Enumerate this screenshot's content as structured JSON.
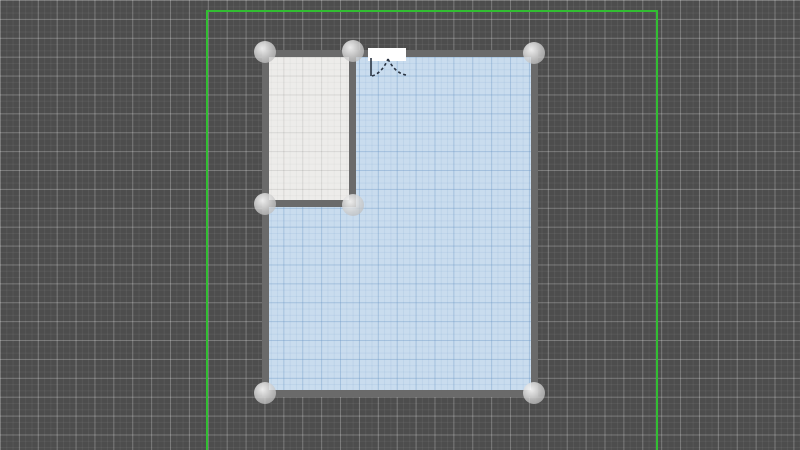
{
  "app": {
    "name": "floor-plan-editor",
    "view": "2d-plan-canvas"
  },
  "canvas": {
    "width": 800,
    "height": 450,
    "background_color": "#4d4d4d",
    "grid": {
      "minor_size_px": 6.3,
      "major_size_px": 18.9,
      "minor_color": "rgba(255,255,255,0.055)",
      "major_color": "rgba(255,255,255,0.21)"
    },
    "plot_boundary": {
      "color": "#32be32",
      "thickness_px": 2,
      "left_x": 206,
      "top_y": 10,
      "right_x": 656,
      "bottom_y": 450
    }
  },
  "walls": {
    "color": "#6a6a6a",
    "thickness_px": 7,
    "segments": [
      {
        "id": "top-wall",
        "x": 262,
        "y": 50,
        "w": 276,
        "h": 7
      },
      {
        "id": "bottom-wall",
        "x": 262,
        "y": 390,
        "w": 276,
        "h": 7
      },
      {
        "id": "left-wall",
        "x": 262,
        "y": 50,
        "w": 7,
        "h": 347
      },
      {
        "id": "right-wall",
        "x": 531,
        "y": 50,
        "w": 7,
        "h": 347
      },
      {
        "id": "divider-wall-vertical",
        "x": 349,
        "y": 50,
        "w": 7,
        "h": 157
      },
      {
        "id": "divider-wall-horizontal",
        "x": 262,
        "y": 200,
        "w": 94,
        "h": 7
      }
    ]
  },
  "rooms": [
    {
      "id": "main-room",
      "fill": "#c9dcee",
      "grid_major_color": "rgba(104,148,194,0.30)",
      "grid_minor_color": "rgba(104,148,194,0.12)",
      "x": 269,
      "y": 57,
      "w": 262,
      "h": 333
    },
    {
      "id": "small-room",
      "fill": "#edecea",
      "grid_major_color": "rgba(0,0,0,0.065)",
      "grid_minor_color": "rgba(0,0,0,0.028)",
      "x": 269,
      "y": 57,
      "w": 80,
      "h": 143
    }
  ],
  "door": {
    "opening": {
      "x": 368,
      "y": 48,
      "w": 38,
      "h": 13,
      "fill": "#ffffff"
    },
    "swing_color": "#2b3442",
    "hinge_left_x": 371,
    "hinge_right_x": 404,
    "wall_bottom_y": 61,
    "leaf_tip_y": 76,
    "peak_x": 388,
    "peak_y": 59
  },
  "handles": {
    "radius_px": 11,
    "nodes": [
      {
        "id": "node-top-left",
        "cx": 265,
        "cy": 52
      },
      {
        "id": "node-top-divider",
        "cx": 353,
        "cy": 51
      },
      {
        "id": "node-top-right",
        "cx": 534,
        "cy": 53
      },
      {
        "id": "node-mid-left",
        "cx": 265,
        "cy": 204
      },
      {
        "id": "node-divider-bottom",
        "cx": 353,
        "cy": 205
      },
      {
        "id": "node-bottom-left",
        "cx": 265,
        "cy": 393
      },
      {
        "id": "node-bottom-right",
        "cx": 534,
        "cy": 393
      }
    ]
  }
}
